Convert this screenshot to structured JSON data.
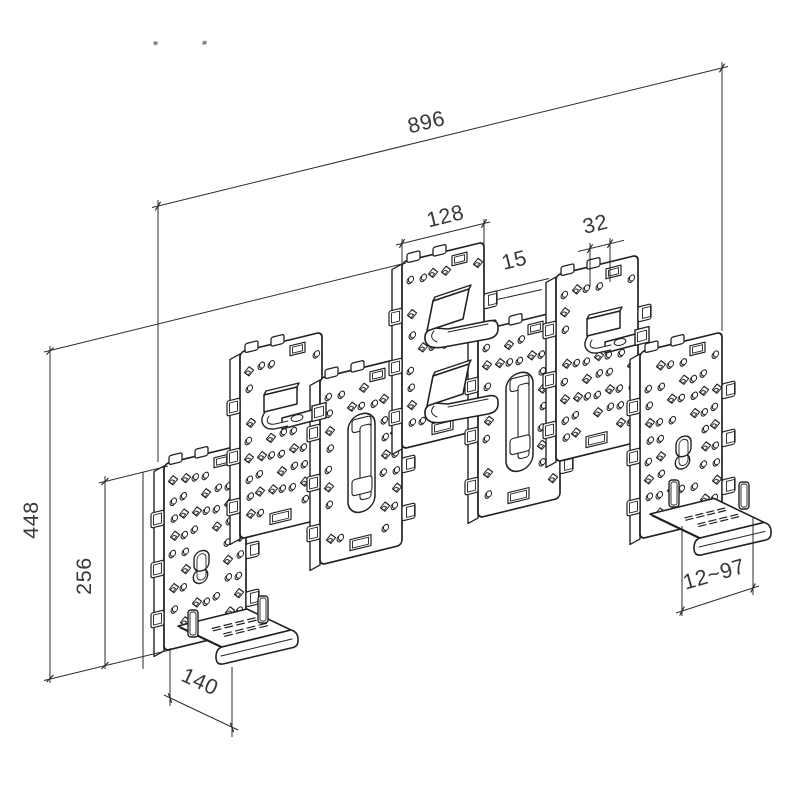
{
  "drawing": {
    "background": "#ffffff",
    "line_color": "#222222",
    "text_color": "#383838",
    "dimensions": {
      "total_width": {
        "value": "896"
      },
      "panel_width": {
        "value": "128"
      },
      "slot_pitch": {
        "value": "32"
      },
      "panel_thickness": {
        "value": "15"
      },
      "total_height": {
        "value": "448"
      },
      "panel_height": {
        "value": "256"
      },
      "shelf_depth": {
        "value": "140"
      },
      "shelf_adjust_range": {
        "value": "12~97"
      }
    },
    "panels": [
      {
        "id": 1,
        "accessory": "keyhole-and-shelf"
      },
      {
        "id": 2,
        "accessory": "hook"
      },
      {
        "id": 3,
        "accessory": "handle-slot"
      },
      {
        "id": 4,
        "accessory": "angled-brackets"
      },
      {
        "id": 5,
        "accessory": "handle-slot"
      },
      {
        "id": 6,
        "accessory": "hook"
      },
      {
        "id": 7,
        "accessory": "keyhole-and-shelf"
      }
    ]
  }
}
